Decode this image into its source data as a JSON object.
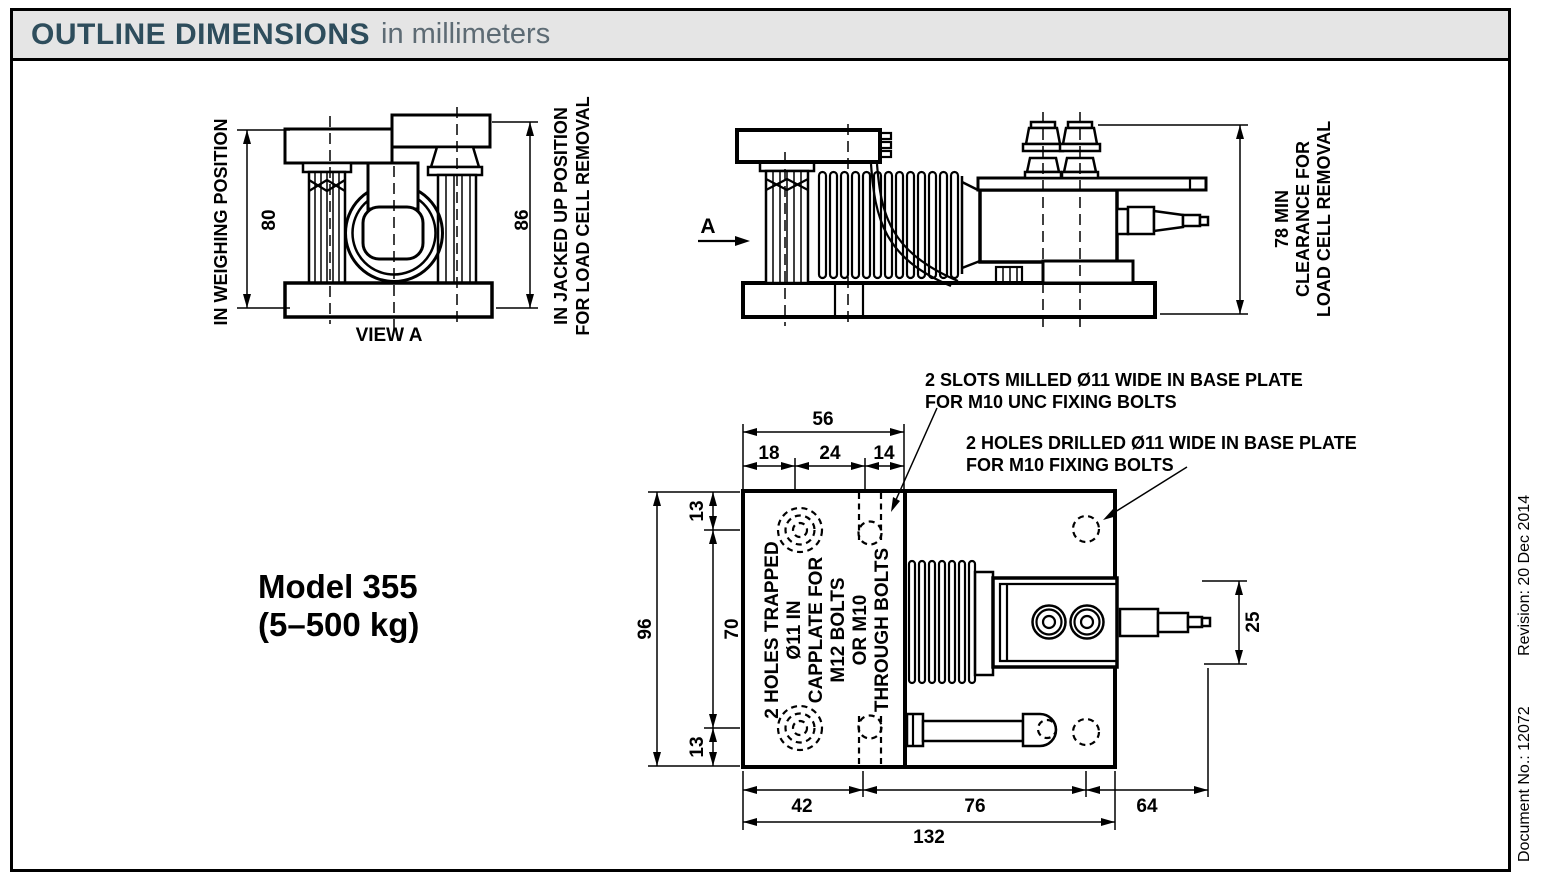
{
  "header": {
    "title": "OUTLINE DIMENSIONS",
    "subtitle": "in millimeters"
  },
  "footer_note": {
    "document_no": "Document No.: 12072",
    "revision": "Revision: 20 Dec 2014"
  },
  "model": {
    "name": "Model 355",
    "capacity": "(5–500 kg)"
  },
  "front_view": {
    "caption_left": "IN WEIGHING POSITION",
    "caption_right_1": "IN JACKED UP POSITION",
    "caption_right_2": "FOR LOAD CELL REMOVAL",
    "dim_weighing": "80",
    "dim_jacked": "86",
    "label": "VIEW A"
  },
  "side_view": {
    "arrow_label": "A",
    "clearance_1": "78 MIN",
    "clearance_2": "CLEARANCE FOR",
    "clearance_3": "LOAD CELL REMOVAL"
  },
  "plan_view": {
    "note_slots_1": "2 SLOTS MILLED Ø11 WIDE IN BASE PLATE",
    "note_slots_2": "FOR M10 UNC FIXING BOLTS",
    "note_holes_1": "2 HOLES DRILLED Ø11 WIDE IN BASE PLATE",
    "note_holes_2": "FOR M10 FIXING BOLTS",
    "note_trapped_1": "2 HOLES TRAPPED",
    "note_trapped_2": "Ø11 IN",
    "note_trapped_3": "CAPPLATE FOR",
    "note_trapped_4": "M12 BOLTS",
    "note_trapped_5": "OR M10",
    "note_trapped_6": "THROUGH BOLTS",
    "dim_top_total": "56",
    "dim_top_a": "18",
    "dim_top_b": "24",
    "dim_top_c": "14",
    "dim_left_total": "96",
    "dim_left_a": "13",
    "dim_left_b": "70",
    "dim_left_c": "13",
    "dim_bottom_a": "42",
    "dim_bottom_b": "76",
    "dim_bottom_c": "64",
    "dim_bottom_total": "132",
    "dim_connector": "25"
  },
  "colors": {
    "title": "#2e4d5c",
    "subtitle": "#5d6b74",
    "line": "#000000",
    "header_bg": "#e5e5e5"
  }
}
